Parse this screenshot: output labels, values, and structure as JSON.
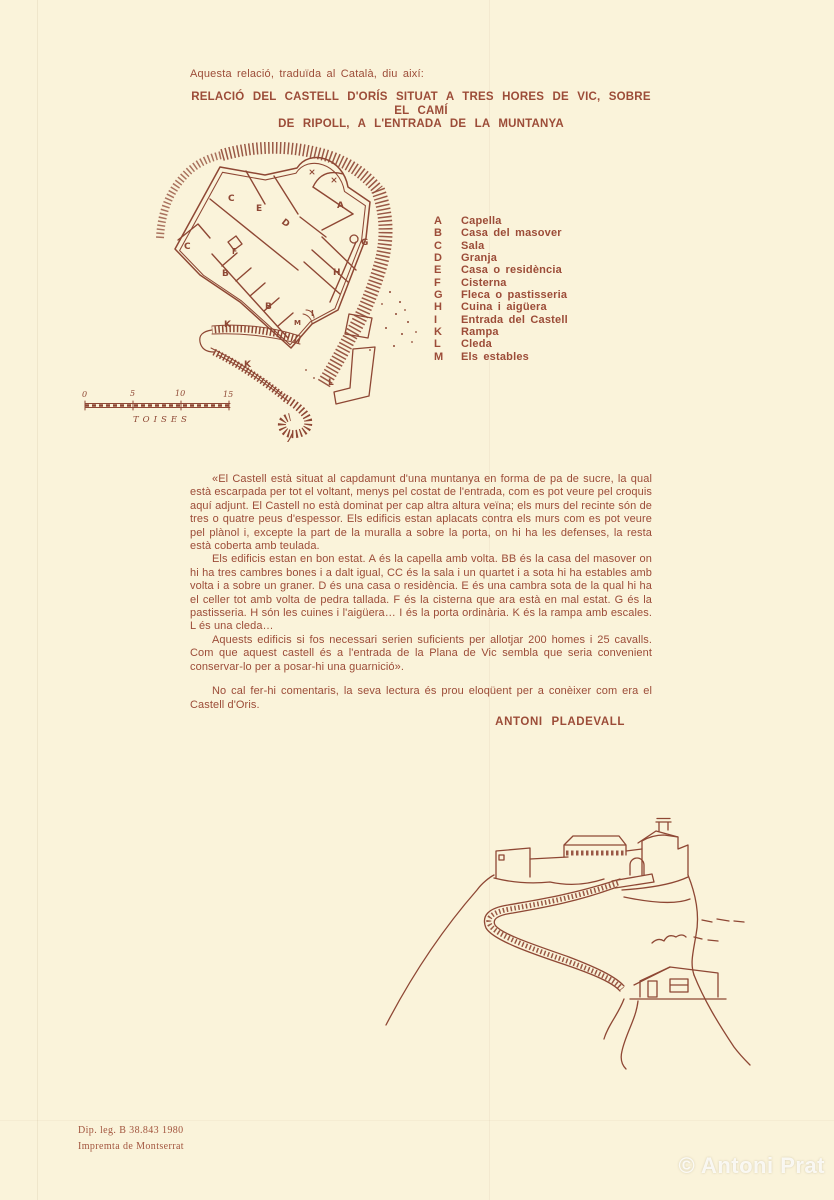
{
  "page": {
    "intro": "Aquesta relació, traduïda al Català, diu així:",
    "headline_line1": "RELACIÓ DEL CASTELL D'ORÍS SITUAT A TRES HORES DE VIC, SOBRE EL CAMÍ",
    "headline_line2": "DE RIPOLL, A L'ENTRADA DE LA MUNTANYA"
  },
  "legend": {
    "items": [
      {
        "letter": "A",
        "label": "Capella"
      },
      {
        "letter": "B",
        "label": "Casa del masover"
      },
      {
        "letter": "C",
        "label": "Sala"
      },
      {
        "letter": "D",
        "label": "Granja"
      },
      {
        "letter": "E",
        "label": "Casa o residència"
      },
      {
        "letter": "F",
        "label": "Cisterna"
      },
      {
        "letter": "G",
        "label": "Fleca o pastisseria"
      },
      {
        "letter": "H",
        "label": "Cuina i aigüera"
      },
      {
        "letter": "I",
        "label": "Entrada del Castell"
      },
      {
        "letter": "K",
        "label": "Rampa"
      },
      {
        "letter": "L",
        "label": "Cleda"
      },
      {
        "letter": "M",
        "label": "Els estables"
      }
    ]
  },
  "plan": {
    "labels": [
      "A",
      "B",
      "B",
      "C",
      "C",
      "D",
      "E",
      "F",
      "G",
      "H",
      "I",
      "K",
      "K",
      "L",
      "M"
    ],
    "scale_ticks": [
      "0",
      "5",
      "10",
      "15"
    ],
    "scale_unit": "TOISES"
  },
  "body": {
    "paragraphs": [
      "«El Castell està situat al capdamunt d'una muntanya en forma de pa de sucre, la qual està escarpada per tot el voltant, menys pel costat de l'entrada, com es pot veure pel croquis aquí adjunt. El Castell no està dominat per cap altra altura veïna; els murs del recinte són de tres o quatre peus d'espessor. Els edificis estan aplacats contra els murs com es pot veure pel plànol i, excepte la part de la muralla a sobre la porta, on hi ha les defenses, la resta està coberta amb teulada.",
      "Els edificis estan en bon estat. A és la capella amb volta. BB és la casa del masover on hi ha tres cambres bones i a dalt igual, CC és la sala i un quartet i a sota hi ha estables amb volta i a sobre un graner. D és una casa o residència. E és una cambra sota de la qual hi ha el celler tot amb volta de pedra tallada. F és la cisterna que ara està en mal estat. G és la pastisseria. H són les cuines i l'aigüera… I és la porta ordinària. K és la rampa amb escales. L és una cleda…",
      "Aquests edificis si fos necessari serien suficients per allotjar 200 homes i 25 cavalls. Com que aquest castell és a l'entrada de la Plana de Vic sembla que seria convenient conservar-lo per a posar-hi una guarnició».",
      "No cal fer-hi comentaris, la seva lectura és prou eloqüent per a conèixer com era el Castell d'Oris."
    ],
    "signature": "ANTONI PLADEVALL"
  },
  "imprint": {
    "line1": "Dip. leg. B 38.843 1980",
    "line2": "Impremta de Montserrat"
  },
  "watermark": "© Antoni Prat",
  "colors": {
    "paper": "#faf3da",
    "ink": "#9c4c38",
    "plan_ink": "#8e4734",
    "watermark": "#ffffff"
  }
}
